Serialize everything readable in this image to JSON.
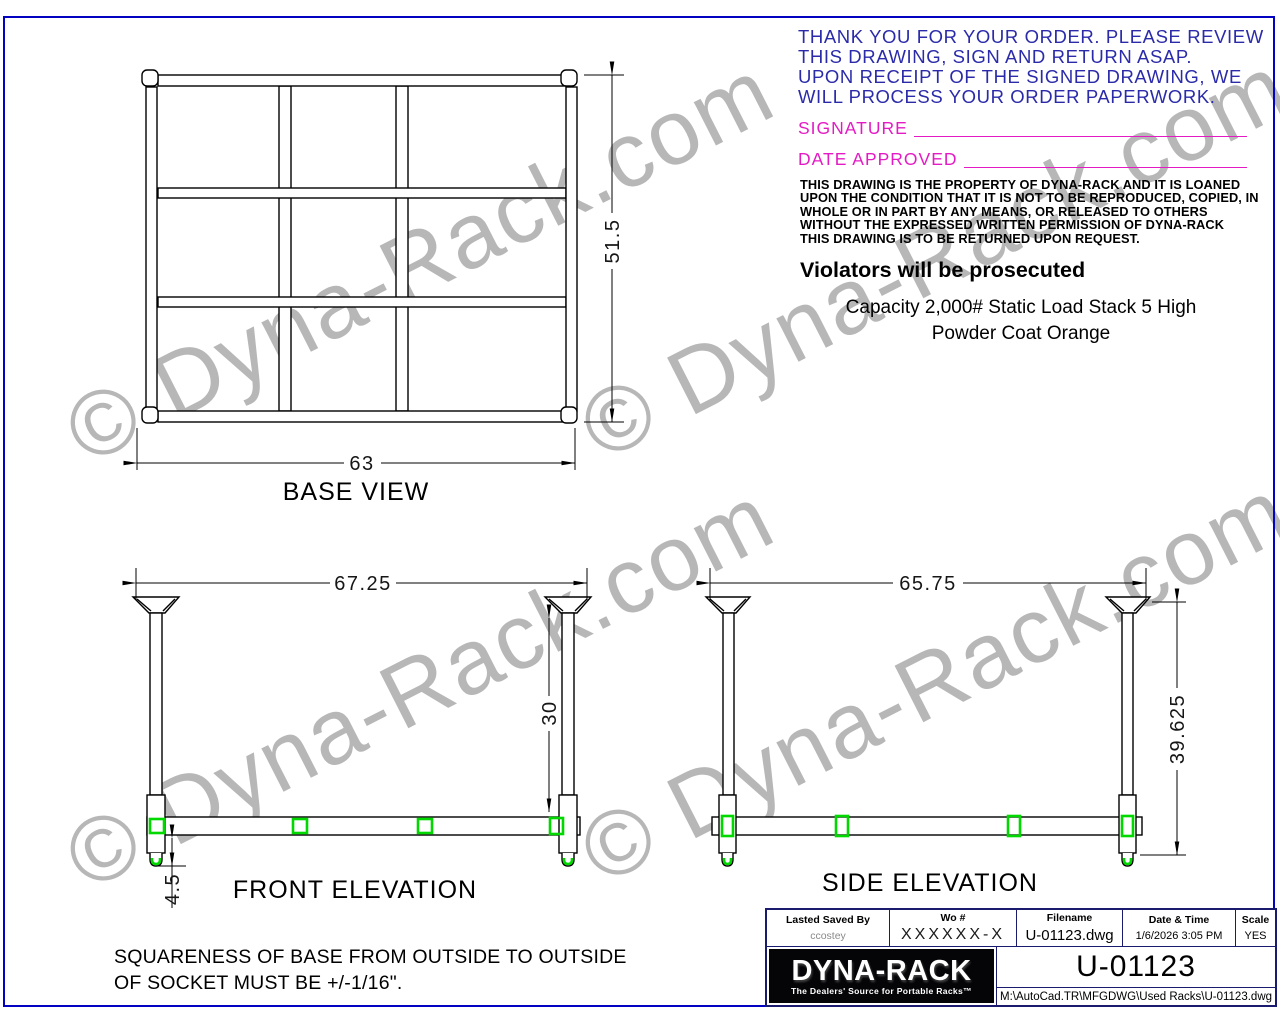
{
  "colors": {
    "sheet_border": "#0202c0",
    "cad_blue_text": "#2b2baa",
    "magenta": "#e41bc4",
    "green_highlight": "#00d800",
    "watermark_gray": "#b7b7b7",
    "titleblock_line": "#1a1a6e"
  },
  "watermark": {
    "text": "© Dyna-Rack.com"
  },
  "order_notice": {
    "lines": [
      "THANK YOU FOR YOUR ORDER. PLEASE REVIEW",
      "THIS DRAWING, SIGN AND RETURN ASAP.",
      "UPON RECEIPT OF THE SIGNED DRAWING, WE",
      "WILL PROCESS YOUR ORDER PAPERWORK."
    ]
  },
  "approval": {
    "signature_label": "SIGNATURE",
    "date_label": "DATE APPROVED"
  },
  "legal": {
    "lines": [
      "THIS DRAWING IS THE PROPERTY OF DYNA-RACK AND IT IS LOANED",
      "UPON THE CONDITION THAT IT IS NOT TO BE REPRODUCED, COPIED, IN",
      "WHOLE OR IN PART BY ANY MEANS, OR RELEASED TO OTHERS",
      "WITHOUT THE EXPRESSED WRITTEN PERMISSION OF DYNA-RACK",
      "THIS DRAWING IS TO BE RETURNED UPON REQUEST."
    ],
    "warning": "Violators will be prosecuted"
  },
  "spec": {
    "line1": "Capacity 2,000# Static Load Stack 5 High",
    "line2": "Powder Coat Orange"
  },
  "views": {
    "base": {
      "label": "BASE VIEW",
      "width_dim": "63",
      "height_dim": "51.5"
    },
    "front": {
      "label": "FRONT ELEVATION",
      "width_dim": "67.25",
      "height_dim": "30",
      "foot_dim": "4.5"
    },
    "side": {
      "label": "SIDE ELEVATION",
      "width_dim": "65.75",
      "height_dim": "39.625"
    }
  },
  "note": {
    "lines": [
      "SQUARENESS OF BASE FROM OUTSIDE TO OUTSIDE",
      "OF SOCKET MUST BE +/-1/16\"."
    ]
  },
  "title_block": {
    "fields": [
      {
        "label": "Lasted Saved By",
        "value": "ccostey"
      },
      {
        "label": "Wo #",
        "value": "XXXXXX-X"
      },
      {
        "label": "Filename",
        "value": "U-01123.dwg"
      },
      {
        "label": "Date & Time",
        "value": "1/6/2026 3:05 PM"
      },
      {
        "label": "Scale",
        "value": "YES"
      }
    ],
    "logo": {
      "name": "DYNA-RACK",
      "tagline": "The Dealers' Source for Portable Racks™"
    },
    "drawing_number": "U-01123",
    "file_path": "M:\\AutoCad.TR\\MFGDWG\\Used Racks\\U-01123.dwg"
  }
}
